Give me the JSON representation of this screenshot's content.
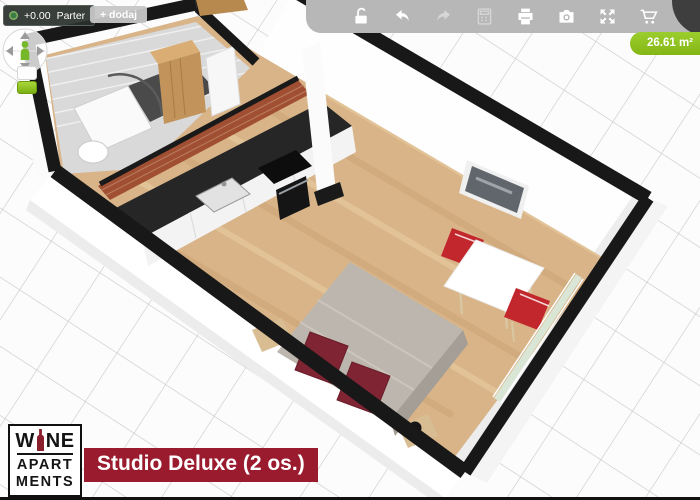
{
  "level_bar": {
    "elevation": "+0.00",
    "level_name": "Parter",
    "add_level_label": "+ dodaj"
  },
  "toolbar": {
    "icons": [
      "lock-open",
      "undo",
      "redo",
      "calculator",
      "print",
      "camera",
      "fullscreen",
      "cart"
    ],
    "disabled_icons": [
      "redo",
      "calculator"
    ]
  },
  "badge": {
    "area": "26.61 m²",
    "color": "#8dc21d"
  },
  "caption": {
    "text": "Studio Deluxe (2 os.)",
    "background": "#9b1b2e"
  },
  "logo": {
    "line1_left": "W",
    "line1_right": "NE",
    "line2": "APART",
    "line3": "MENTS"
  },
  "scene": {
    "type": "3d-floor-plan",
    "objects": [
      "bathroom-shower",
      "toilet",
      "wardrobe",
      "entrance-door",
      "brick-wall",
      "kitchen-counter",
      "kitchen-sink",
      "cooktop",
      "oven",
      "bed",
      "pillows",
      "bedside-lamp-left",
      "bedside-lamp-right",
      "dining-table",
      "dining-chair-top",
      "dining-chair-bottom",
      "wall-picture",
      "window"
    ]
  }
}
